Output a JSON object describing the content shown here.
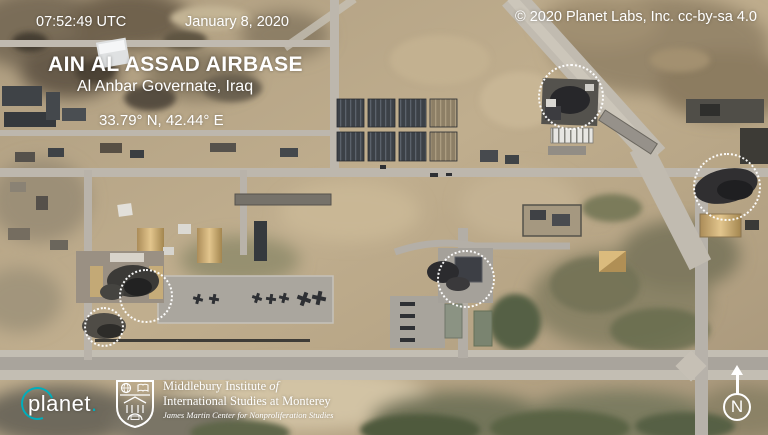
{
  "header": {
    "timestamp": "07:52:49 UTC",
    "date": "January 8, 2020",
    "credit": "© 2020 Planet Labs, Inc. cc-by-sa 4.0"
  },
  "location": {
    "title": "AIN AL ASSAD AIRBASE",
    "subtitle": "Al Anbar Governate, Iraq",
    "coordinates": "33.79° N, 42.44° E"
  },
  "annotations": {
    "style": "dotted-white-circle",
    "markers": [
      {
        "id": "impact-site-1",
        "x": 571,
        "y": 97,
        "r": 33
      },
      {
        "id": "impact-site-2",
        "x": 727,
        "y": 187,
        "r": 34
      },
      {
        "id": "impact-site-3",
        "x": 466,
        "y": 279,
        "r": 29
      },
      {
        "id": "impact-site-4",
        "x": 146,
        "y": 296,
        "r": 27
      },
      {
        "id": "impact-site-5",
        "x": 104,
        "y": 327,
        "r": 20
      }
    ]
  },
  "branding": {
    "planet": {
      "wordmark": "planet",
      "period": ".",
      "accent_color": "#00aebc"
    },
    "institute": {
      "line1_regular": "Middlebury Institute ",
      "line1_italic": "of",
      "line2": "International Studies at Monterey",
      "line3": "James Martin Center for Nonproliferation Studies"
    }
  },
  "compass": {
    "label": "N"
  },
  "colors": {
    "overlay_text": "#ffffff",
    "annotation_circle": "#ffffff",
    "planet_teal": "#00aebc"
  }
}
